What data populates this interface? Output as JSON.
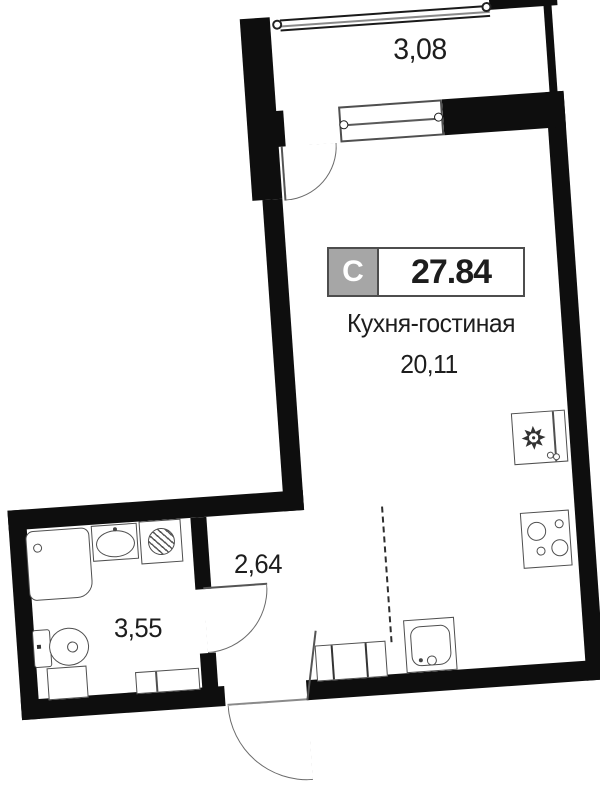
{
  "floor_plan": {
    "badge": {
      "letter": "С",
      "value": "27.84"
    },
    "rooms": {
      "balcony": {
        "area": "3,08"
      },
      "kitchen_living": {
        "name": "Кухня-гостиная",
        "area": "20,11"
      },
      "hallway": {
        "area": "2,64"
      },
      "bathroom": {
        "area": "3,55"
      }
    },
    "fixtures": {
      "balcony": [
        "balcony-window",
        "balcony-door"
      ],
      "kitchen_living": [
        "refrigerator",
        "stove",
        "kitchen-sink"
      ],
      "hallway": [
        "wardrobe",
        "entrance-door",
        "zone-dashed-line"
      ],
      "bathroom": [
        "shower-tray",
        "washbasin",
        "washing-machine",
        "toilet",
        "cabinet",
        "cabinet-wide",
        "bathroom-door"
      ]
    },
    "colors": {
      "wall": "#0e0e0e",
      "fixture_line": "#4f4f4f",
      "door_line": "#6a6a6a",
      "badge_gray": "#a6a6a6",
      "badge_border": "#4d4d4d",
      "text": "#1d1d1d",
      "background": "#ffffff"
    }
  }
}
